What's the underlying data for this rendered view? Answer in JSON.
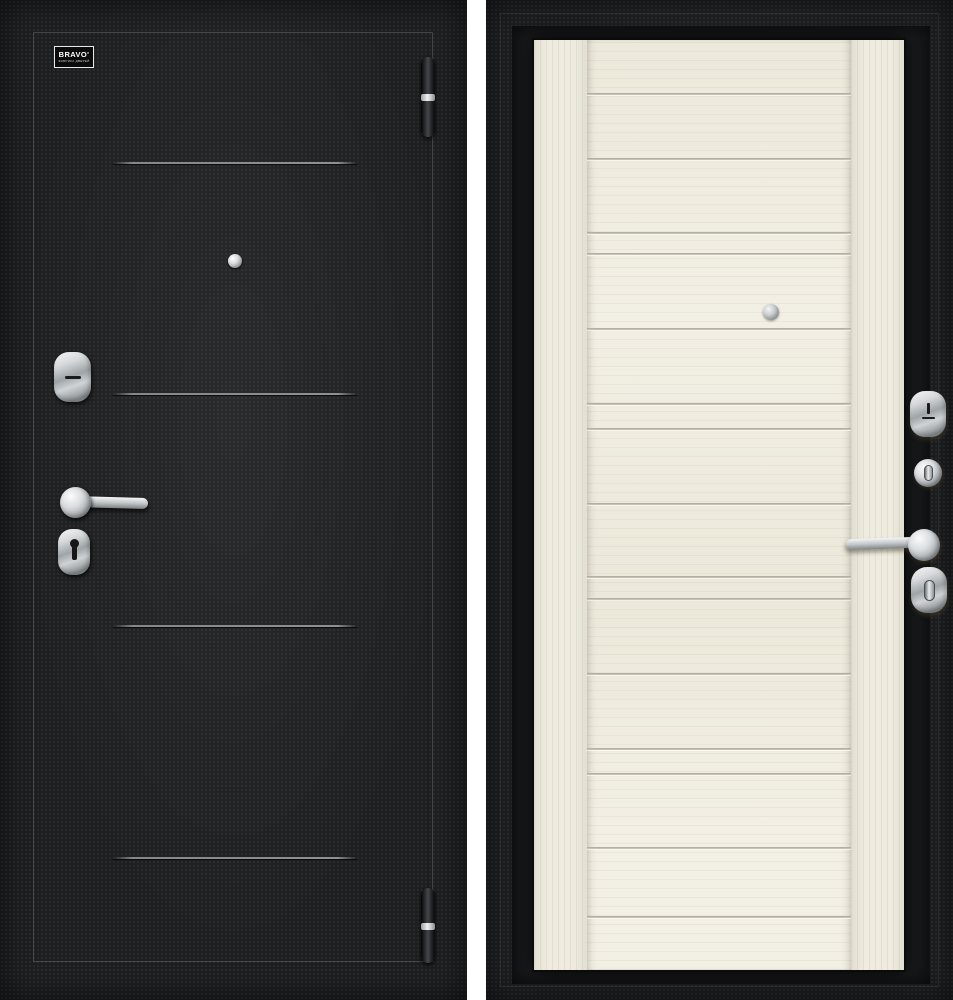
{
  "scene": {
    "description": "Steel entry door product photo: exterior black side (left) and interior light wood side (right)",
    "left_view": "door-exterior-black",
    "right_view": "door-interior-light-wood"
  },
  "logo": {
    "brand": "BRAVO'",
    "tagline": "ФАБРИКА ДВЕРЕЙ"
  },
  "colors": {
    "door_black": "#1e1f21",
    "frame_black": "#191a1c",
    "front_groove_gray": "#8c8c8c",
    "wood_base": "#f1eee3",
    "wood_groove": "#b0ad9f",
    "chrome_light": "#f6f7f8",
    "chrome_dark": "#7d8285",
    "gap_white": "#ffffff"
  },
  "front_door": {
    "groove_lines_y": [
      162,
      393,
      625,
      857
    ],
    "hinges": [
      {
        "y": 57,
        "h": 80
      },
      {
        "y": 888,
        "h": 75
      }
    ],
    "hardware": [
      "brand-plate",
      "peephole",
      "cylinder-escutcheon",
      "lever-handle",
      "keyhole-escutcheon",
      "hinge",
      "hinge"
    ]
  },
  "back_door": {
    "panel_top_y": 40,
    "plank_lines_y": [
      93,
      158,
      232,
      253,
      328,
      403,
      428,
      503,
      576,
      598,
      673,
      748,
      773,
      847,
      916
    ],
    "hardware": [
      "peephole",
      "cylinder-escutcheon",
      "thumbturn-knob",
      "lever-handle",
      "oval-thumbturn"
    ]
  }
}
